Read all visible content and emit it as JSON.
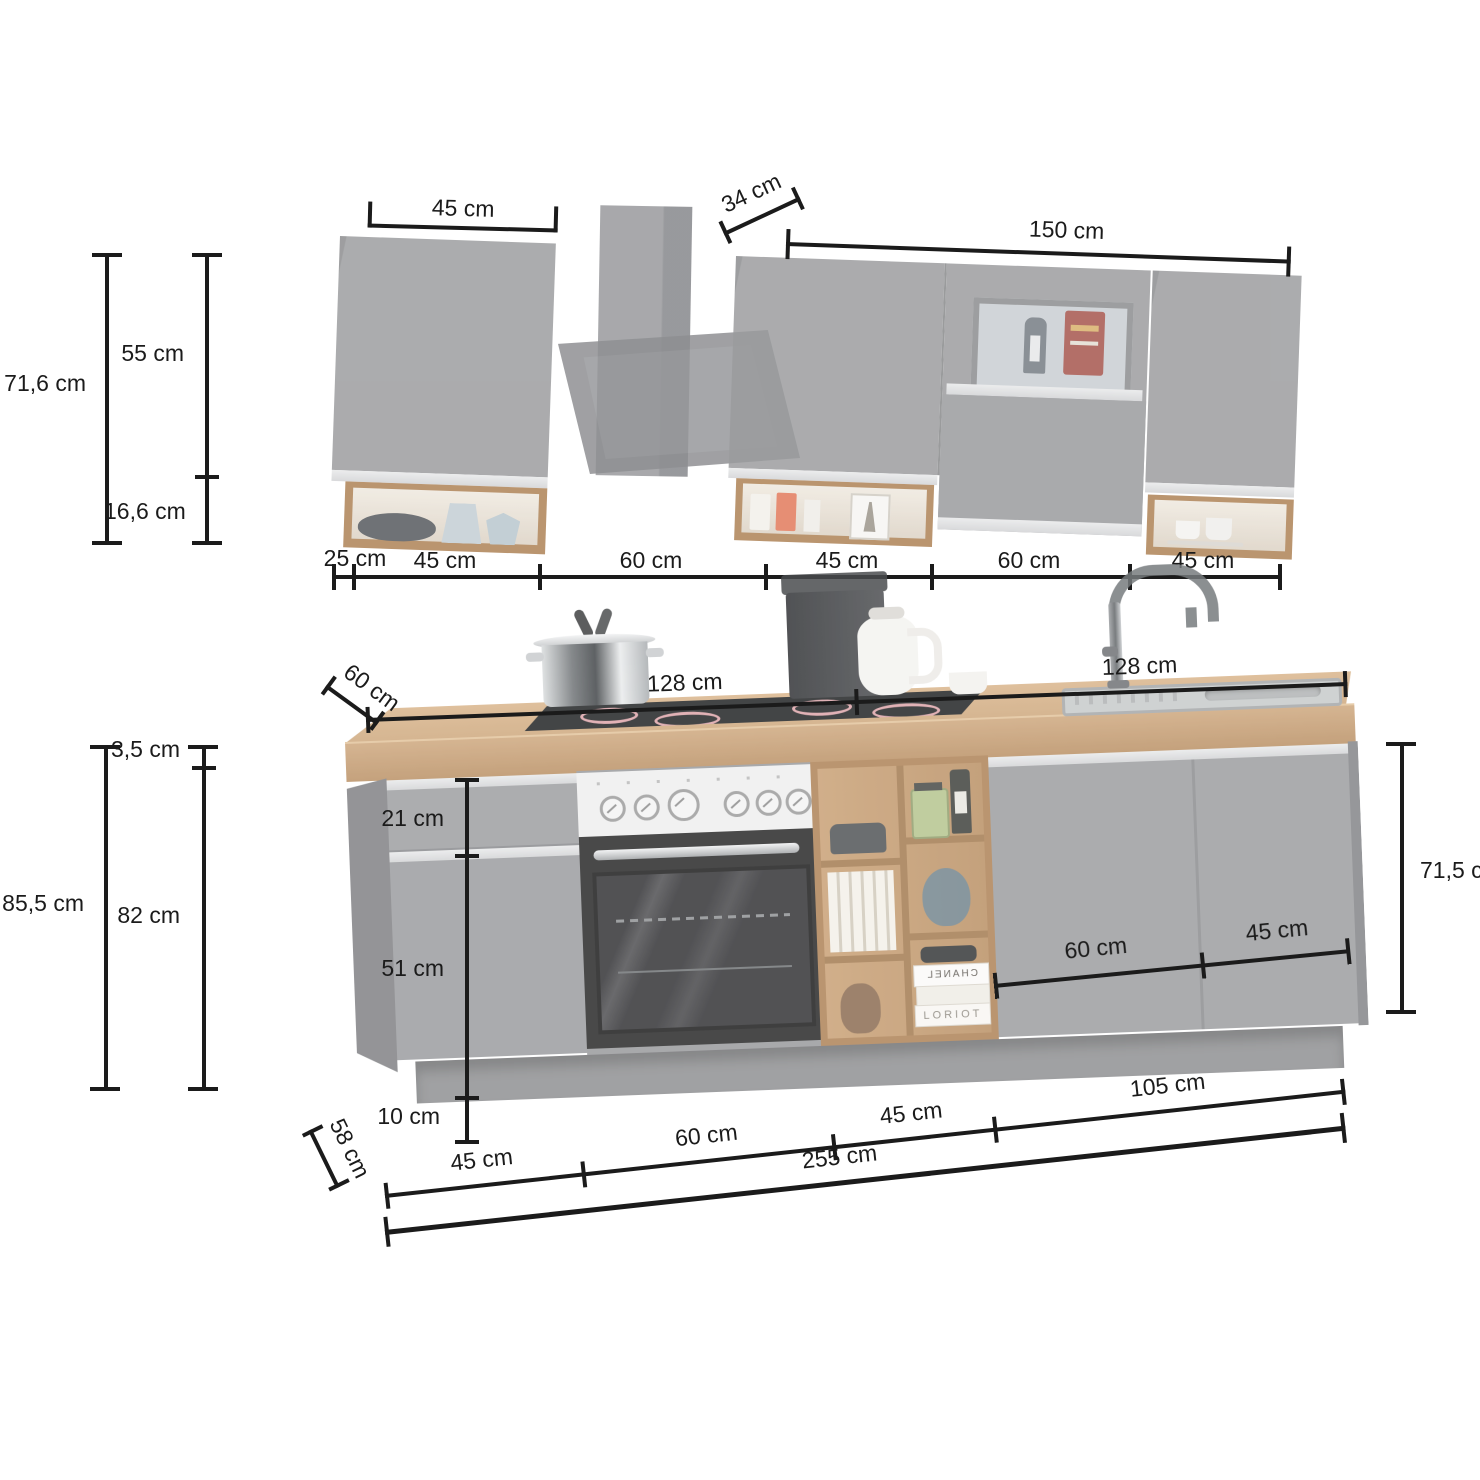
{
  "colors": {
    "line": "#1b1b1b",
    "cabinet_gray": "#9b9c9e",
    "metal_strip": "#dcddde",
    "wood_frame": "#ad8154",
    "counter_wood": "#c9a478",
    "oven_black": "#262626",
    "burner_pink": "#dba3a8"
  },
  "top": {
    "width_left": "45 cm",
    "depth": "34 cm",
    "width_right": "150 cm",
    "height_total": "71,6 cm",
    "height_cabinet": "55 cm",
    "height_shelf": "16,6 cm",
    "row": [
      "25 cm",
      "45 cm",
      "60 cm",
      "45 cm",
      "60 cm",
      "45 cm"
    ]
  },
  "base": {
    "depth_top": "60 cm",
    "span_left": "128 cm",
    "span_right": "128 cm",
    "height_total": "85,5 cm",
    "counter_thickness": "3,5 cm",
    "height_body": "82 cm",
    "drawer_front": "21 cm",
    "door_front": "51 cm",
    "plinth": "10 cm",
    "height_right": "71,5 cm",
    "door_left": "60 cm",
    "door_right": "45 cm",
    "row": [
      "45 cm",
      "60 cm",
      "45 cm",
      "105 cm"
    ],
    "total_width": "255 cm",
    "depth_bottom": "58 cm"
  },
  "decor": {
    "book_spine_1": "CHANEL",
    "book_spine_2": "LORIOT"
  }
}
